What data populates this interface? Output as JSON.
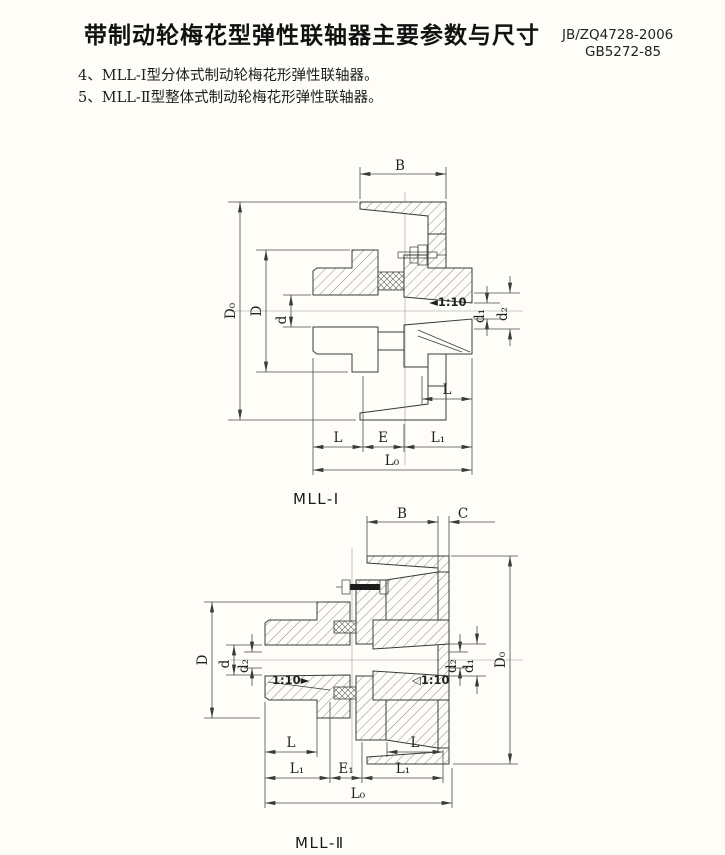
{
  "colors": {
    "background": "#fffdf8",
    "ink": "#1c1c1c",
    "line": "#3a3a3a"
  },
  "header": {
    "title": "带制动轮梅花型弹性联轴器主要参数与尺寸",
    "standard_primary": "JB/ZQ4728-2006",
    "standard_secondary": "GB5272-85"
  },
  "notes": [
    "4、MLL-Ⅰ型分体式制动轮梅花形弹性联轴器。",
    "5、MLL-Ⅱ型整体式制动轮梅花形弹性联轴器。"
  ],
  "fig1": {
    "caption": "MLL-Ⅰ",
    "taper": "◄1:10",
    "dims": {
      "b": "B",
      "d0": "D₀",
      "D": "D",
      "d": "d",
      "d1": "d₁",
      "d2": "d₂",
      "l_inner": "L",
      "l": "L",
      "e": "E",
      "l1": "L₁",
      "l0": "L₀"
    }
  },
  "fig2": {
    "caption": "MLL-Ⅱ",
    "taper_left": "1:10►",
    "taper_right": "◁1:10",
    "dims": {
      "b": "B",
      "c": "C",
      "D": "D",
      "d": "d",
      "d2_left": "d₂",
      "d2_right": "d₂",
      "d1": "d₁",
      "d0": "D₀",
      "l_left": "L",
      "l_right": "L",
      "l1_left": "L₁",
      "e1": "E₁",
      "l1_right": "L₁",
      "l0": "L₀"
    }
  }
}
